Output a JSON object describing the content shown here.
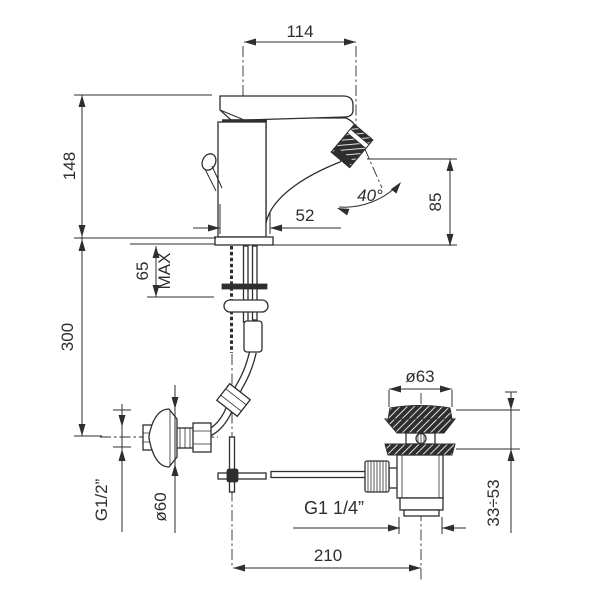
{
  "drawing": {
    "subject": "single-lever bidet mixer with pop-up waste - installation dimensions",
    "colors": {
      "ink": "#2e2e2e",
      "background": "#ffffff"
    },
    "dims": {
      "spout_reach": "114",
      "spout_height": "148",
      "deck_max_value": "65",
      "deck_max_label": "MAX",
      "body_width": "52",
      "aerator_angle": "40°",
      "rim_to_aerator": "85",
      "inlet_height": "300",
      "inlet_thread": "G1/2”",
      "escutcheon_dia": "ø60",
      "waste_thread": "G1 1/4”",
      "waste_offset": "210",
      "waste_flange_dia": "ø63",
      "waste_clamp_range": "33÷53"
    }
  }
}
